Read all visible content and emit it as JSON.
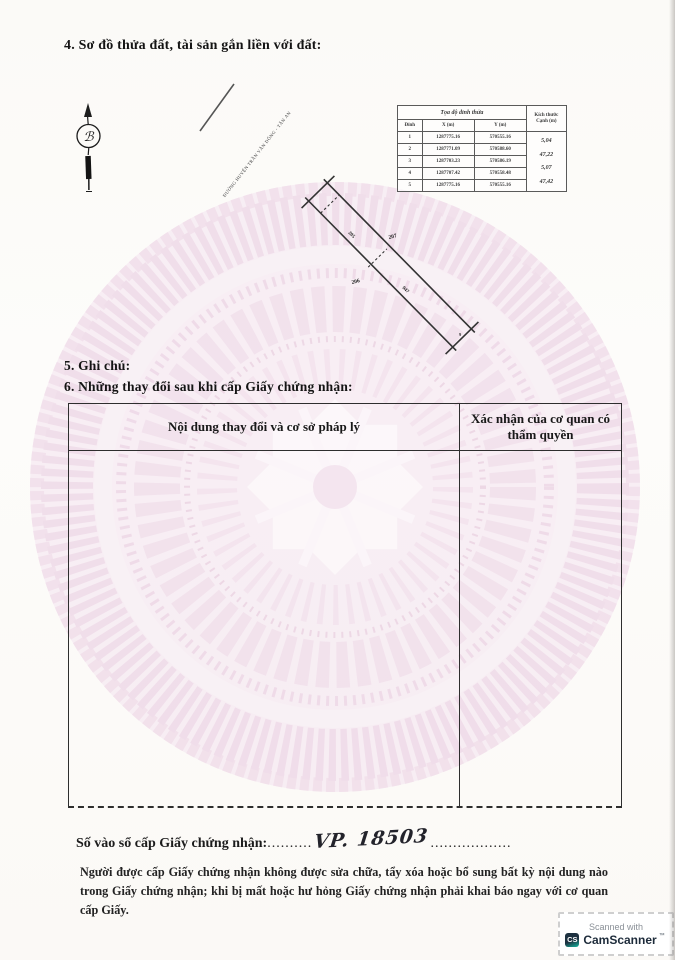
{
  "document": {
    "section4_title": "4. Sơ đồ thửa đất, tài sản gắn liền với đất:",
    "section5_title": "5. Ghi chú:",
    "section6_title": "6. Những thay đổi sau khi cấp Giấy chứng nhận:",
    "register_label": "Số vào sổ cấp Giấy chứng nhận:",
    "register_dots_left": "..........",
    "register_number_handwritten": "VP. 18503",
    "register_dots_right": "..................",
    "footer_note": "Người được cấp Giấy chứng nhận không được sửa chữa, tẩy xóa hoặc bổ sung bất kỳ nội dung nào trong Giấy chứng nhận; khi bị mất hoặc hư hỏng Giấy chứng nhận phải khai báo ngay với cơ quan cấp Giấy."
  },
  "compass": {
    "north_letter": "ℬ"
  },
  "plot_diagram": {
    "road_label": "ĐƯỜNG HUYỆN TRẦN VĂN DÕNG - TÂN AN",
    "parcel_number_upper": "207",
    "parcel_number_lower": "206",
    "strip_label_upper": "205",
    "strip_label_lower": "947",
    "end_vertex_mark": "9"
  },
  "coord_table": {
    "group_header": "Tọa độ đỉnh thửa",
    "vertex_header": "Đỉnh",
    "x_header": "X (m)",
    "y_header": "Y (m)",
    "edge_header_line1": "Kích thước",
    "edge_header_line2": "Cạnh (m)",
    "rows": [
      {
        "v": "1",
        "x": "1287775.16",
        "y": "570555.16"
      },
      {
        "v": "2",
        "x": "1287771.09",
        "y": "570588.60"
      },
      {
        "v": "3",
        "x": "1287703.23",
        "y": "570586.19"
      },
      {
        "v": "4",
        "x": "1287707.42",
        "y": "570558.48"
      },
      {
        "v": "5",
        "x": "1287775.16",
        "y": "570555.16"
      }
    ],
    "edge_lengths": [
      "5,04",
      "47,22",
      "5,07",
      "47,42"
    ]
  },
  "change_table": {
    "col1_header": "Nội dung thay đổi và cơ sở pháp lý",
    "col2_header": "Xác nhận của cơ quan có thẩm quyền"
  },
  "camscanner": {
    "line1": "Scanned with",
    "logo_text": "CS",
    "brand": "CamScanner",
    "tm": "™"
  },
  "colors": {
    "watermark_pink": "#eed6e6",
    "ink": "#1f1f1f",
    "badge_navy": "#1d2b3a",
    "badge_teal": "#14b8a0"
  }
}
